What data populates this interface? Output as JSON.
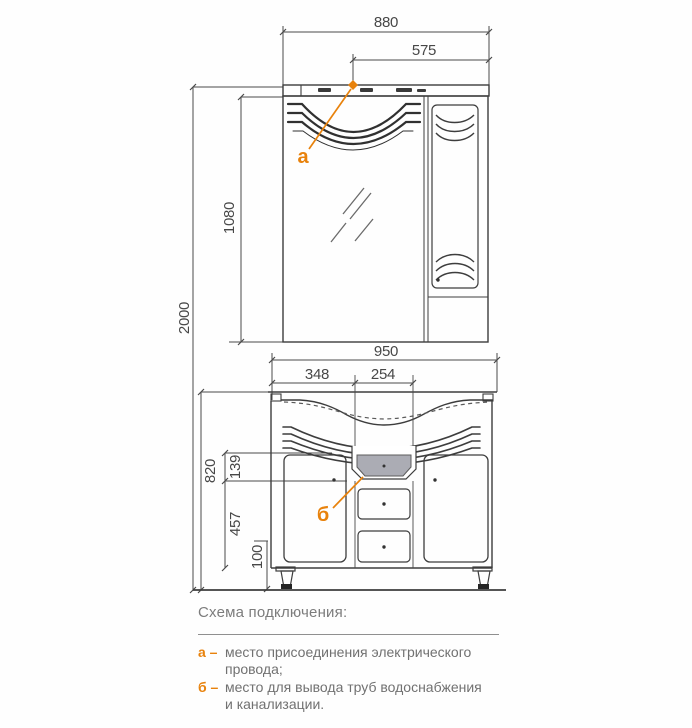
{
  "colors": {
    "accent_orange": "#e8820c",
    "drawing_line": "#3d3d3d",
    "dimension_line": "#555555",
    "legend_text": "#717171",
    "drain_fill": "#abacb4"
  },
  "drawing": {
    "dims": {
      "cabinet_width": "880",
      "light_offset": "575",
      "mirror_height": "1080",
      "total_height": "2000",
      "vanity_width": "950",
      "left_offset": "348",
      "drain_width": "254",
      "vanity_height": "820",
      "recess_height": "139",
      "door_height": "457",
      "leg_height": "100"
    },
    "labels": {
      "point_a": "а",
      "point_b": "б"
    }
  },
  "legend": {
    "title": "Схема подключения:",
    "items": [
      {
        "key": "а –",
        "line1": "место присоединения электрического",
        "line2": "провода;"
      },
      {
        "key": "б –",
        "line1": "место для вывода труб водоснабжения",
        "line2": "и канализации."
      }
    ]
  }
}
